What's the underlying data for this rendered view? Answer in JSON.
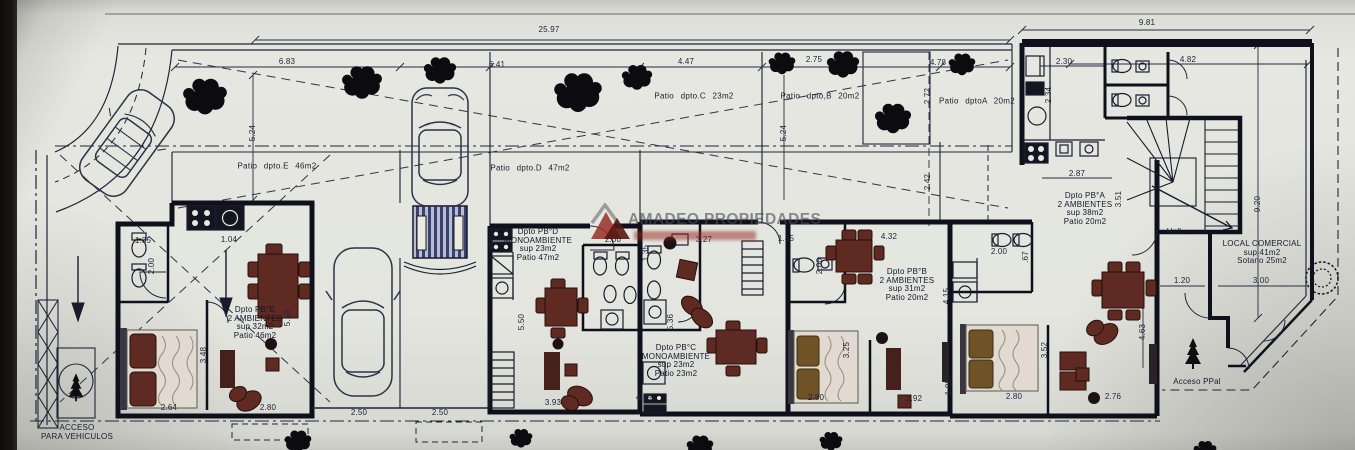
{
  "watermark": {
    "brand": "AMADEO PROPIEDADES"
  },
  "apartments": [
    {
      "id": "pb-e",
      "lines": [
        "Dpto PB°E",
        "2 AMBIENTES",
        "sup 32m2",
        "Patio 46m2"
      ],
      "x": 255,
      "y": 306
    },
    {
      "id": "pb-d",
      "lines": [
        "Dpto PB°D",
        "MONOAMBIENTE",
        "sup 23m2",
        "Patio 47m2"
      ],
      "x": 538,
      "y": 228
    },
    {
      "id": "pb-c",
      "lines": [
        "Dpto PB°C",
        "MONOAMBIENTE",
        "sup 23m2",
        "Patio 23m2"
      ],
      "x": 676,
      "y": 344
    },
    {
      "id": "pb-b",
      "lines": [
        "Dpto PB°B",
        "2 AMBIENTES",
        "sup 31m2",
        "Patio 20m2"
      ],
      "x": 907,
      "y": 268
    },
    {
      "id": "pb-a",
      "lines": [
        "Dpto PB°A",
        "2 AMBIENTES",
        "sup 38m2",
        "Patio 20m2"
      ],
      "x": 1085,
      "y": 192
    }
  ],
  "patios": [
    {
      "label": "Patio dpto.E 46m2",
      "x": 277,
      "y": 166
    },
    {
      "label": "Patio dpto.D 47m2",
      "x": 530,
      "y": 168
    },
    {
      "label": "Patio dpto.C 23m2",
      "x": 694,
      "y": 96
    },
    {
      "label": "Patio dpto,B 20m2",
      "x": 820,
      "y": 96
    },
    {
      "label": "Patio dptoA 20m2",
      "x": 977,
      "y": 101
    }
  ],
  "areas": [
    {
      "id": "hall",
      "lines": [
        "Hall"
      ],
      "x": 1174,
      "y": 228
    },
    {
      "id": "local-comercial",
      "lines": [
        "LOCAL COMERCIAL",
        "sup 41m2",
        "Sotano 25m2"
      ],
      "x": 1262,
      "y": 240
    },
    {
      "id": "acceso-ppal",
      "lines": [
        "Acceso PPal"
      ],
      "x": 1197,
      "y": 378
    },
    {
      "id": "acceso-vehiculos",
      "lines": [
        "ACCESO",
        "PARA VEHICULOS"
      ],
      "x": 77,
      "y": 424
    }
  ],
  "dimensions": [
    {
      "v": "25.97",
      "x": 549,
      "y": 30
    },
    {
      "v": "9.81",
      "x": 1147,
      "y": 23
    },
    {
      "v": "6.83",
      "x": 287,
      "y": 62
    },
    {
      "v": "6.41",
      "x": 497,
      "y": 65
    },
    {
      "v": "4.47",
      "x": 686,
      "y": 62
    },
    {
      "v": "2.75",
      "x": 814,
      "y": 60
    },
    {
      "v": "4.78",
      "x": 938,
      "y": 63
    },
    {
      "v": "2.30",
      "x": 1064,
      "y": 62
    },
    {
      "v": "4.82",
      "x": 1188,
      "y": 60
    },
    {
      "v": "5.24",
      "x": 253,
      "y": 133,
      "r": 1
    },
    {
      "v": "5.24",
      "x": 784,
      "y": 133,
      "r": 1
    },
    {
      "v": "2.72",
      "x": 928,
      "y": 96,
      "r": 1
    },
    {
      "v": "2.42",
      "x": 928,
      "y": 182,
      "r": 1
    },
    {
      "v": "2.34",
      "x": 1049,
      "y": 95,
      "r": 1
    },
    {
      "v": "2.87",
      "x": 1077,
      "y": 174
    },
    {
      "v": "3.51",
      "x": 1119,
      "y": 199,
      "r": 1
    },
    {
      "v": "9.20",
      "x": 1258,
      "y": 204,
      "r": 1
    },
    {
      "v": "1.35",
      "x": 143,
      "y": 241
    },
    {
      "v": "2.00",
      "x": 152,
      "y": 266,
      "r": 1
    },
    {
      "v": "1.04",
      "x": 229,
      "y": 240
    },
    {
      "v": "2.00",
      "x": 613,
      "y": 240
    },
    {
      "v": "1.35",
      "x": 646,
      "y": 253,
      "r": 1
    },
    {
      "v": "3.27",
      "x": 704,
      "y": 240
    },
    {
      "v": "1.35",
      "x": 786,
      "y": 239
    },
    {
      "v": "2.00",
      "x": 820,
      "y": 266,
      "r": 1
    },
    {
      "v": "4.32",
      "x": 889,
      "y": 237
    },
    {
      "v": "2.00",
      "x": 999,
      "y": 252
    },
    {
      "v": ".67",
      "x": 1026,
      "y": 257,
      "r": 1
    },
    {
      "v": "5.50",
      "x": 522,
      "y": 322,
      "r": 1
    },
    {
      "v": "5.36",
      "x": 671,
      "y": 322,
      "r": 1
    },
    {
      "v": "3.25",
      "x": 847,
      "y": 350,
      "r": 1
    },
    {
      "v": "3.48",
      "x": 204,
      "y": 355,
      "r": 1
    },
    {
      "v": "5.50",
      "x": 288,
      "y": 318,
      "r": 1
    },
    {
      "v": "4.15",
      "x": 947,
      "y": 296,
      "r": 1
    },
    {
      "v": "3.52",
      "x": 1045,
      "y": 350,
      "r": 1
    },
    {
      "v": "1.05",
      "x": 949,
      "y": 387,
      "r": 1
    },
    {
      "v": "4.63",
      "x": 1143,
      "y": 332,
      "r": 1
    },
    {
      "v": "2.64",
      "x": 169,
      "y": 408
    },
    {
      "v": "2.80",
      "x": 268,
      "y": 408
    },
    {
      "v": "2.50",
      "x": 359,
      "y": 413
    },
    {
      "v": "2.50",
      "x": 440,
      "y": 413
    },
    {
      "v": "3.93",
      "x": 553,
      "y": 403
    },
    {
      "v": "4.29",
      "x": 644,
      "y": 398
    },
    {
      "v": "2.80",
      "x": 816,
      "y": 398
    },
    {
      "v": "2.92",
      "x": 914,
      "y": 399
    },
    {
      "v": "2.80",
      "x": 1014,
      "y": 397
    },
    {
      "v": "2.76",
      "x": 1113,
      "y": 397
    },
    {
      "v": "1.20",
      "x": 1182,
      "y": 281
    },
    {
      "v": "3.00",
      "x": 1261,
      "y": 281
    }
  ]
}
